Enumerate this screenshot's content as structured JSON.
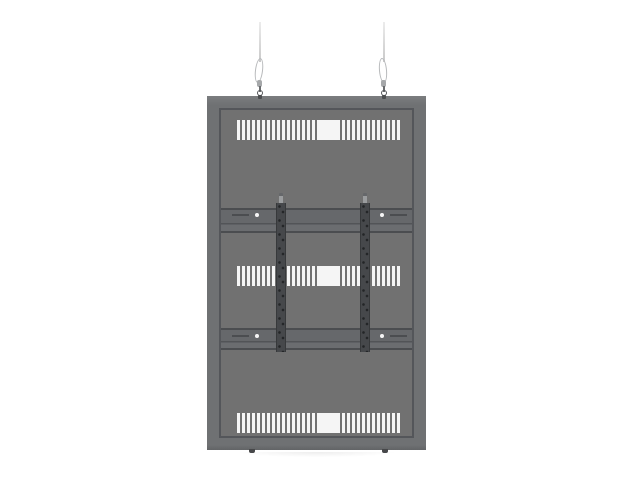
{
  "meta": {
    "description": "Back view of a dark gray portrait display ceiling mount panel suspended from two steel wires, with three rows of white ventilation slots, two vertical VESA mounting rails and two horizontal crossbars",
    "visible_text": ""
  },
  "colors": {
    "bg": "#ffffff",
    "frame": "#6f7173",
    "frame_top": "#7b7d7f",
    "frame_bottom": "#626466",
    "face": "#717171",
    "line": "#54565a",
    "bar": "#66686b",
    "bar_line": "#4b4d50",
    "rail": "#46484b",
    "rail_edge": "#37393b",
    "hole": "#232527",
    "slot": "#f5f5f5",
    "wire": "#c9c9c9"
  },
  "structure": {
    "vent_rows_count": 3,
    "slots_per_row": 33,
    "rails_count": 2,
    "crossbars_count": 2,
    "suspension_wires_count": 2
  },
  "vent_rows": [
    {
      "name": "top",
      "x": 16,
      "y": 10,
      "w": 163,
      "h": 20,
      "box_x": 80
    },
    {
      "name": "middle",
      "x": 16,
      "y": 156,
      "w": 163,
      "h": 20,
      "box_x": 80
    },
    {
      "name": "bottom",
      "x": 16,
      "y": 303,
      "w": 163,
      "h": 20,
      "box_x": 80
    }
  ],
  "crossbars": [
    {
      "name": "upper",
      "y": 98,
      "h": 25,
      "slot_y": 6,
      "screw_y": 5
    },
    {
      "name": "lower",
      "y": 218,
      "h": 22,
      "slot_y": 7,
      "screw_y": 6
    }
  ],
  "rails": [
    {
      "name": "left",
      "x": 55
    },
    {
      "name": "right",
      "x": 139
    }
  ],
  "suspensions": [
    {
      "name": "left",
      "x": 260,
      "lean": 7
    },
    {
      "name": "right",
      "x": 384,
      "lean": -5
    }
  ],
  "feet": [
    {
      "name": "left",
      "x": 252
    },
    {
      "name": "right",
      "x": 385
    }
  ]
}
